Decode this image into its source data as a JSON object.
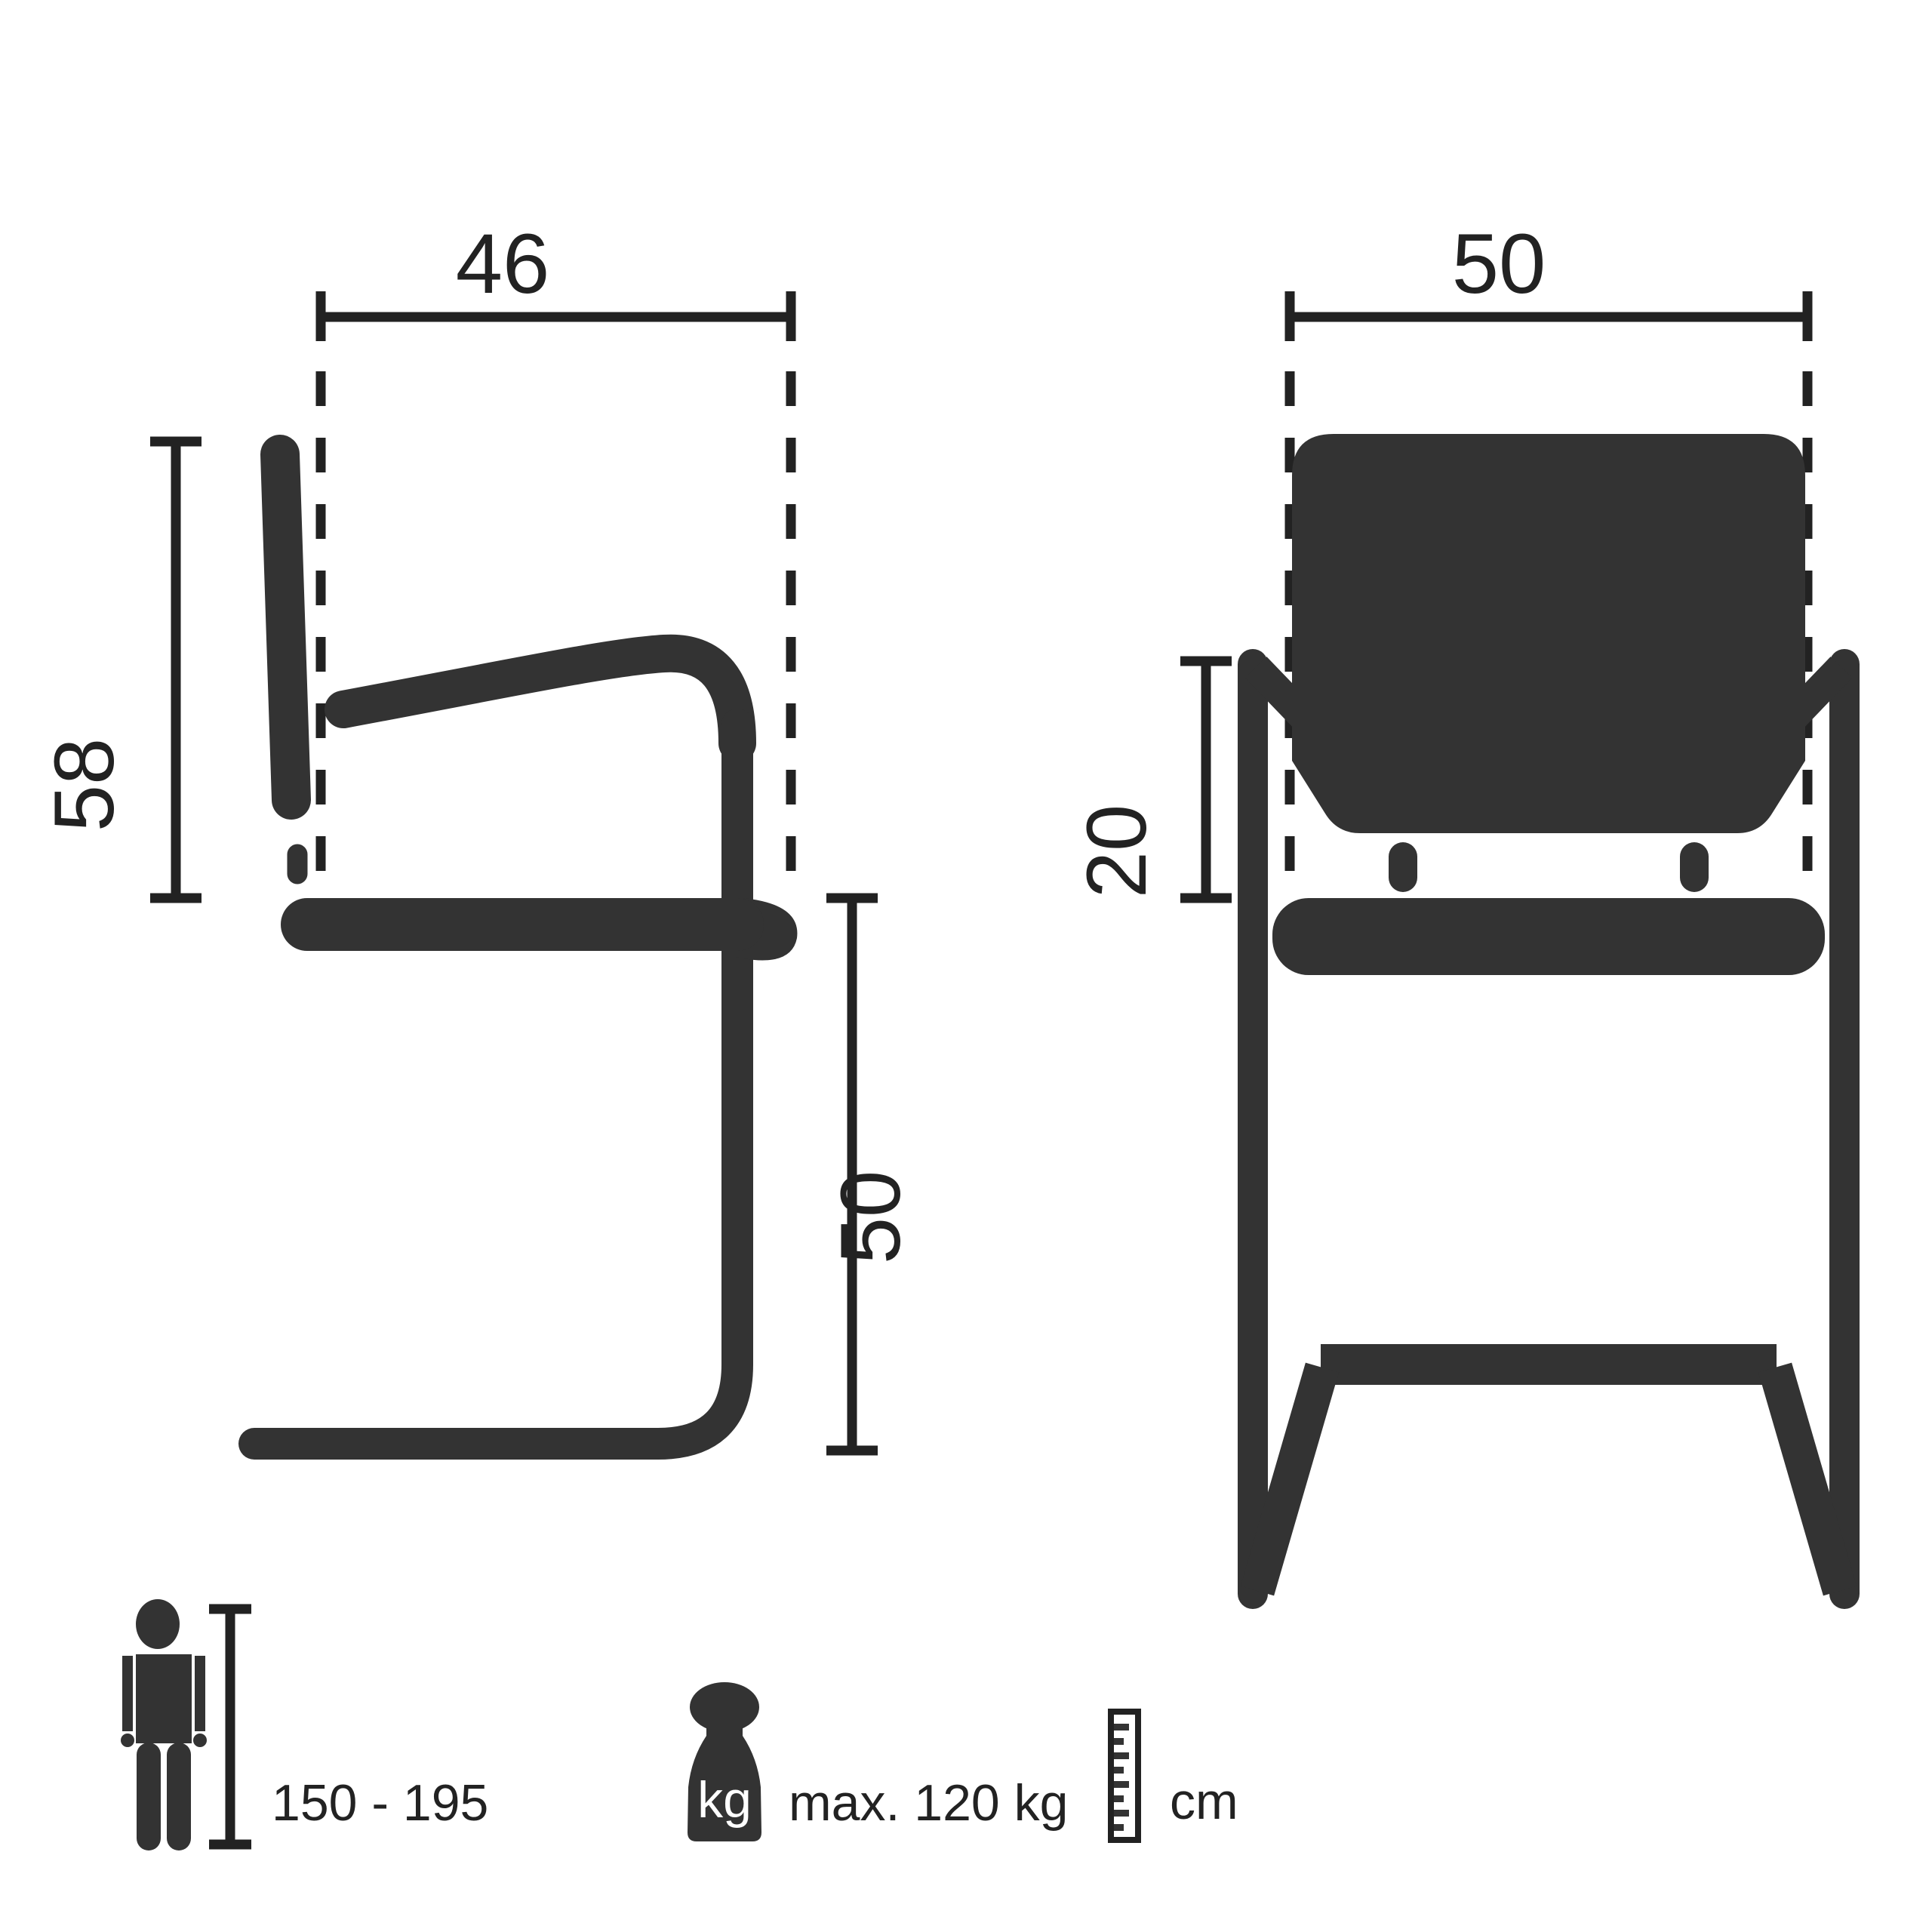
{
  "colors": {
    "background": "#ffffff",
    "figure": "#333333",
    "line": "#222222"
  },
  "side_view": {
    "seat_depth_label": "46",
    "backrest_height_label": "58",
    "seat_height_label": "50"
  },
  "front_view": {
    "seat_width_label": "50",
    "armrest_height_label": "20"
  },
  "legend": {
    "person_height_range": "150 - 195",
    "weight_unit": "kg",
    "max_weight": "max. 120 kg",
    "ruler_unit": "cm"
  }
}
